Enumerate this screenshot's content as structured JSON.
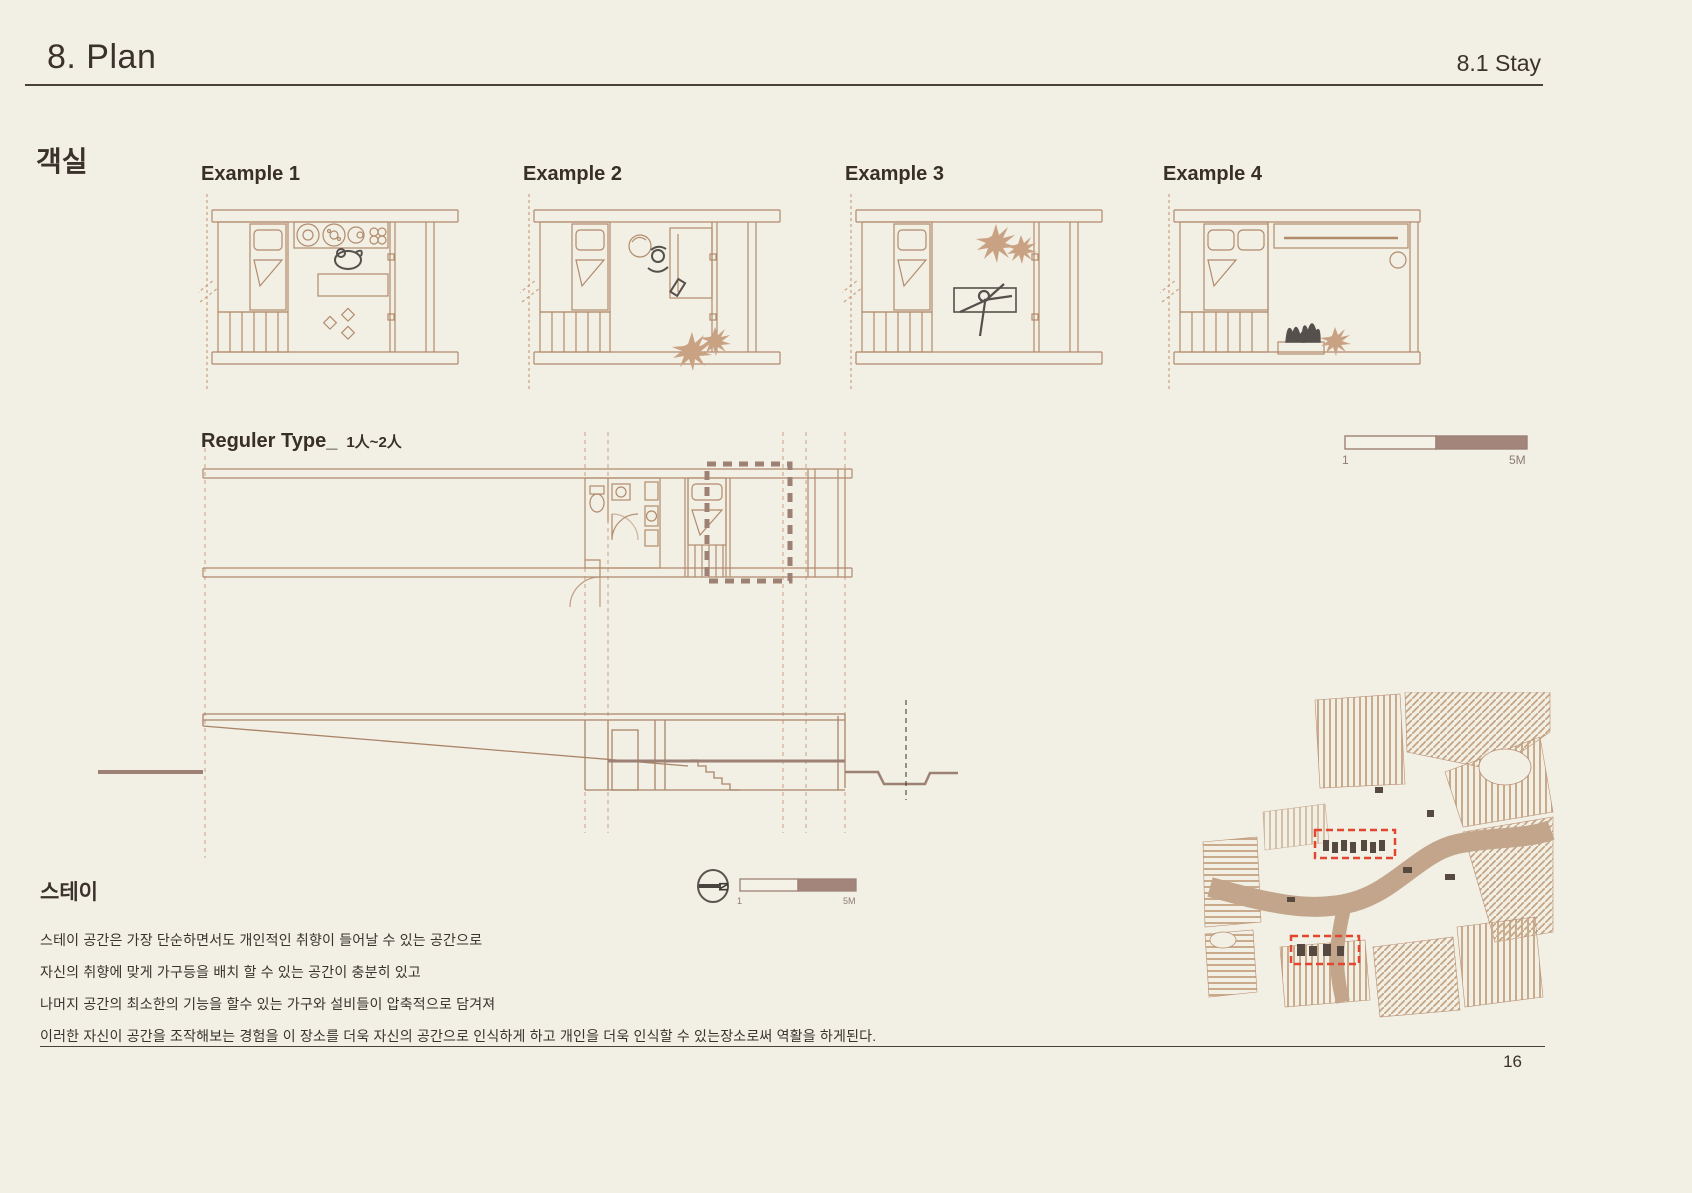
{
  "header": {
    "title": "8. Plan",
    "subtitle": "8.1 Stay"
  },
  "guestroom_label": "객실",
  "examples": [
    {
      "label": "Example 1"
    },
    {
      "label": "Example 2"
    },
    {
      "label": "Example 3"
    },
    {
      "label": "Example 4"
    }
  ],
  "regular_type": {
    "label": "Reguler Type_",
    "capacity": "1人~2人"
  },
  "scalebar_top": {
    "start": "1",
    "end": "5M"
  },
  "scalebar_mid": {
    "start": "1",
    "end": "5M"
  },
  "compass": {
    "letter": "N"
  },
  "stay": {
    "heading": "스테이",
    "paragraphs": [
      "스테이 공간은 가장 단순하면서도 개인적인 취향이 들어날 수 있는 공간으로",
      "자신의 취향에 맞게 가구등을 배치 할 수 있는 공간이 충분히 있고",
      "나머지 공간의 최소한의 기능을 할수 있는 가구와 설비들이 압축적으로 담겨져",
      "이러한 자신이 공간을 조작해보는 경험을 이 장소를 더욱 자신의 공간으로 인식하게 하고 개인을 더욱 인식할 수 있는장소로써 역활을 하게된다."
    ]
  },
  "page_number": "16",
  "colors": {
    "background": "#f2efe4",
    "ink": "#3b332b",
    "plan_line_tan": "#b28b6d",
    "highlight_mauve": "#9d8175",
    "scalebar_fill": "#a4857c",
    "site_red": "#e2462f"
  }
}
